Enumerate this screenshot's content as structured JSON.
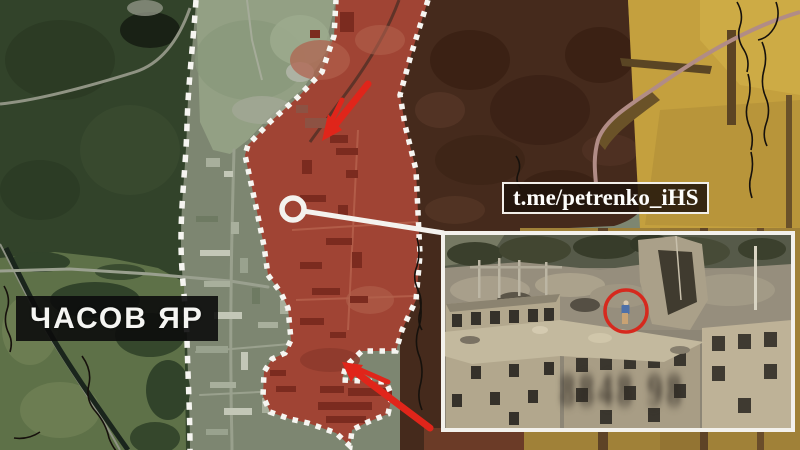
{
  "labels": {
    "place_name": "ЧАСОВ ЯР",
    "channel_watermark": "t.me/petrenko_iHS"
  },
  "map": {
    "type": "satellite",
    "assault_zone_fill": "#a04434",
    "assault_zone_border": "white-dotted",
    "front_line_style": "white-dashed",
    "front_line_color": "#f6f5f1",
    "arrow_color": "#e0251a",
    "trench_line_color": "#16110c",
    "arrows": [
      {
        "id": "north-attack-arrow",
        "direction": "southwest"
      },
      {
        "id": "south-attack-arrow",
        "direction": "northwest"
      }
    ],
    "callout": {
      "shape": "circle-with-leader-line",
      "connects_to": "inset-photo"
    }
  },
  "inset": {
    "border_color": "#f3f1ec",
    "highlight_circle_color": "#d6291e",
    "blurred_stamp": "8848 98"
  }
}
